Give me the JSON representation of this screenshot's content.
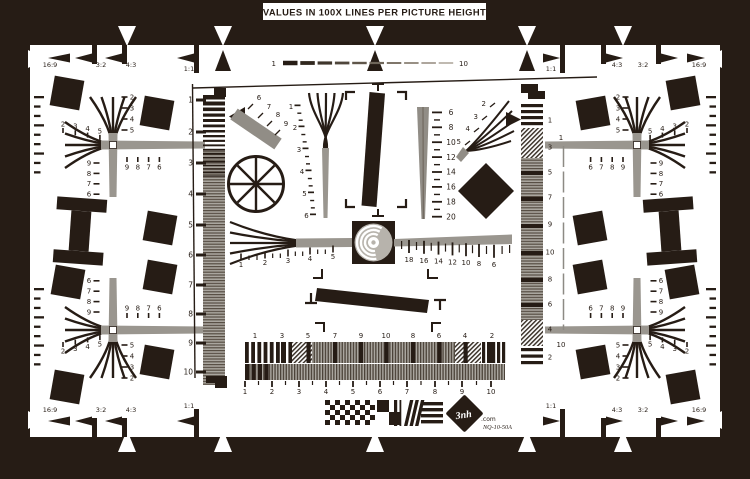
{
  "title": "VALUES IN 100X LINES PER PICTURE HEIGHT",
  "logo": {
    "brand": "3nh",
    "suffix": ".com",
    "model": "NQ-10-50A"
  },
  "colors": {
    "ink": "#261c15",
    "white": "#ffffff",
    "gray": "#9a968f",
    "gray_dark": "#918d86",
    "gray_light": "#b7b3ac"
  },
  "aspect_markers": {
    "top_left": [
      "16:9",
      "3:2",
      "4:3",
      "1:1"
    ],
    "top_right": [
      "1:1",
      "4:3",
      "3:2",
      "16:9"
    ],
    "bottom_left": [
      "16:9",
      "3:2",
      "4:3",
      "1:1"
    ],
    "bottom_right": [
      "1:1",
      "4:3",
      "3:2",
      "16:9"
    ]
  },
  "corner_cross_labels": {
    "outer_vertical": [
      "2",
      "3",
      "4",
      "5"
    ],
    "outer_horizontal": [
      "2",
      "3",
      "4",
      "5"
    ],
    "inner_vertical": [
      "9",
      "8",
      "7",
      "6"
    ],
    "inner_horizontal": [
      "9",
      "8",
      "7",
      "6"
    ]
  },
  "center": {
    "top_dashed_scale": {
      "start": "1",
      "end": "10"
    },
    "left_bar_scale": [
      "1",
      "2",
      "3",
      "4",
      "5",
      "6",
      "7",
      "8",
      "9",
      "10"
    ],
    "diagonal_bar_ticks": [
      "6",
      "7",
      "8",
      "9"
    ],
    "center_wedge_scale": [
      "1",
      "2",
      "3",
      "4",
      "5",
      "6"
    ],
    "fine_wedge_scale": [
      "6",
      "8",
      "10",
      "12",
      "14",
      "16",
      "18",
      "20"
    ],
    "fan_scale": [
      "2",
      "3",
      "4",
      "5"
    ],
    "horizontal_left_scale": [
      "1",
      "2",
      "3",
      "4",
      "5"
    ],
    "horizontal_right_scale": [
      "18",
      "16",
      "14",
      "12",
      "10",
      "8",
      "6"
    ],
    "bank_top_scale": [
      "1",
      "3",
      "5",
      "7",
      "9",
      "10",
      "8",
      "6",
      "4",
      "2"
    ],
    "bank_bottom_scale": [
      "1",
      "2",
      "3",
      "4",
      "5",
      "6",
      "7",
      "8",
      "9",
      "10"
    ],
    "right_column_scale": [
      "1",
      "3",
      "5",
      "7",
      "9",
      "10",
      "8",
      "6",
      "4",
      "2"
    ],
    "right_dashed_scale": {
      "start": "1",
      "end": "10"
    }
  }
}
